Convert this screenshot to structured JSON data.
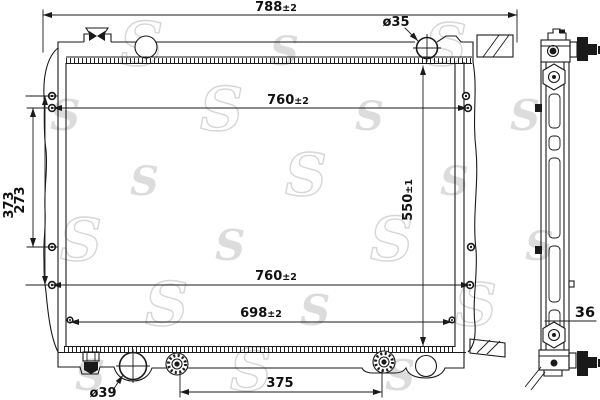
{
  "drawing": {
    "type": "radiator technical drawing, front and side view",
    "colors": {
      "background": "#ffffff",
      "line": "#1a1a1a",
      "watermark": "#dcdcdc"
    }
  },
  "watermark": {
    "glyph": "S"
  },
  "dimensions": {
    "width_overall": {
      "value": "788",
      "tol": "±2"
    },
    "width_pins_upper": {
      "value": "760",
      "tol": "±2"
    },
    "width_pins_lower": {
      "value": "760",
      "tol": "±2"
    },
    "width_bottom": {
      "value": "698",
      "tol": "±2"
    },
    "bracket_span_outer": {
      "value": "373"
    },
    "bracket_span_inner": {
      "value": "273"
    },
    "core_height": {
      "value": "550",
      "tol": "±1"
    },
    "inlet_neck_diameter": {
      "value": "ø35"
    },
    "outlet_diameter": {
      "value": "ø39"
    },
    "drain_plug_spacing": {
      "value": "375"
    },
    "core_thickness": {
      "value": "36"
    }
  }
}
